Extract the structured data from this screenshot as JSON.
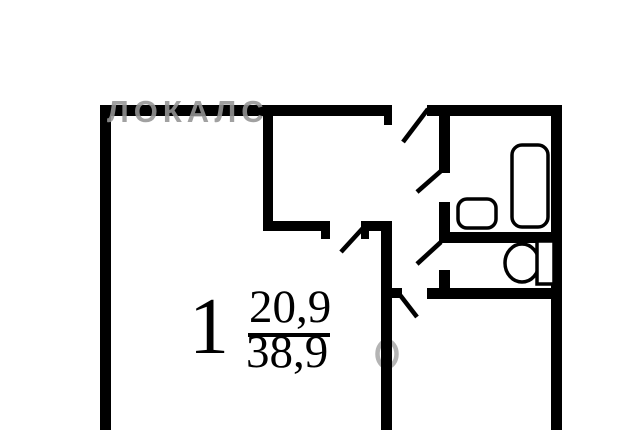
{
  "watermark": {
    "brand_text": "ЛОКАЛС",
    "color": "#949494",
    "ring_glyph": "О",
    "ring_color": "#b4b4b4"
  },
  "floor_plan": {
    "room_label": {
      "number": "1",
      "living_area": "20,9",
      "total_area": "38,9"
    },
    "fixtures": [
      "bathtub",
      "sink",
      "toilet"
    ],
    "doors": [
      "entry-door",
      "bathroom-door",
      "toilet-door",
      "room-door",
      "kitchen-door"
    ],
    "colors": {
      "wall": "#000000",
      "background": "#ffffff",
      "fixture_fill": "#ffffff",
      "fixture_outline": "#000000"
    }
  }
}
